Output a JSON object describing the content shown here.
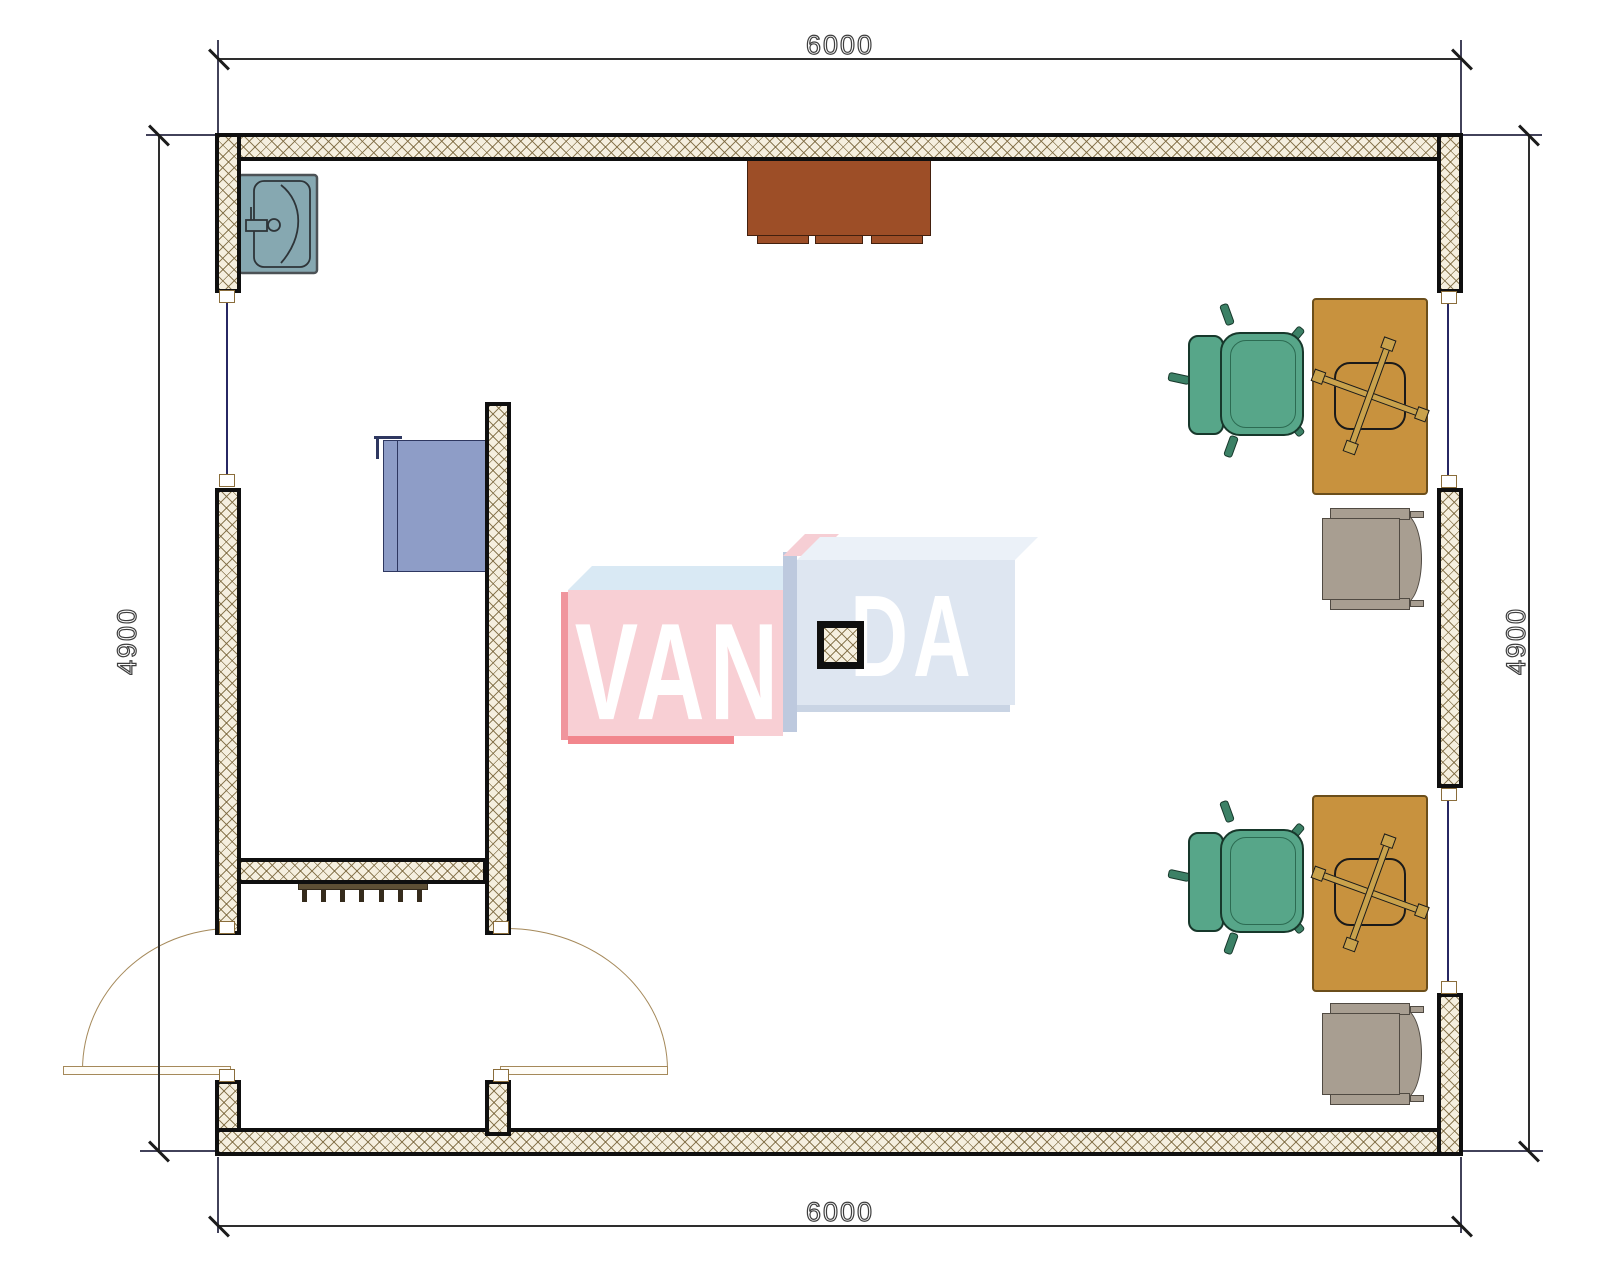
{
  "plan": {
    "type": "architectural-floor-plan",
    "dimensions": {
      "top": "6000",
      "bottom": "6000",
      "left": "4900",
      "right": "4900"
    },
    "watermark": {
      "full": "VANDA",
      "part_left": "VAN",
      "part_right": "DA"
    },
    "colors": {
      "wall_outline": "#0f0f0f",
      "wall_fill": "#f5efdf",
      "wall_hatch_line": "#7a663c",
      "dimension_line": "#2e2e2e",
      "window_glazing": "#272763",
      "door_arc": "#a5895a",
      "sink": "#86a8b1",
      "wall_cabinet": "#9d4e27",
      "counter": "#8e9dc7",
      "radiator": "#5d4f35",
      "desk": "#c8923e",
      "office_chair": "#57a689",
      "armchair": "#a89e91",
      "watermark_pink": "#f8cfd4",
      "watermark_blue": "#dee6f1"
    },
    "furniture": [
      {
        "name": "sink",
        "location": "top-left"
      },
      {
        "name": "wall-cabinet",
        "location": "top-center"
      },
      {
        "name": "counter",
        "location": "inner-room"
      },
      {
        "name": "radiator",
        "location": "inner-room-south-wall"
      },
      {
        "name": "desk",
        "count": 2,
        "location": "right"
      },
      {
        "name": "office-chair",
        "count": 2,
        "location": "right"
      },
      {
        "name": "armchair",
        "count": 2,
        "location": "right"
      },
      {
        "name": "column",
        "location": "center"
      },
      {
        "name": "double-swing-doors",
        "location": "bottom-left"
      }
    ]
  }
}
